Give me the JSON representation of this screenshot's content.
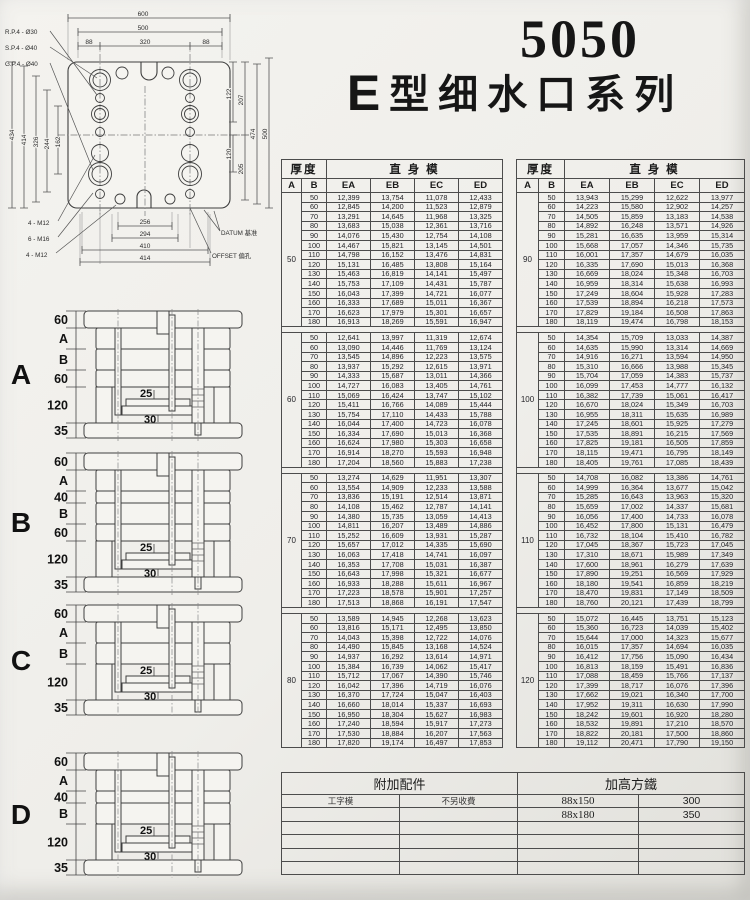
{
  "title": {
    "model": "5050",
    "series_e": "E",
    "series_rest": "型细水口系列"
  },
  "drawing": {
    "top_dims": [
      "600",
      "500",
      "88",
      "320",
      "88"
    ],
    "left_dims": [
      "434",
      "414",
      "326",
      "244",
      "162"
    ],
    "right_dims": [
      "122",
      "120",
      "207",
      "205",
      "474",
      "500"
    ],
    "bottom_dims": [
      "256",
      "294",
      "410",
      "414"
    ],
    "leader_labels": [
      "R.P.4 - Ø30",
      "S.P.4 - Ø40",
      "G.P.4 - Ø40"
    ],
    "screw_labels": [
      "4 - M12",
      "6 - M16",
      "4 - M12"
    ],
    "datum_label": "DATUM 基准",
    "offset_label": "OFFSET 偏孔"
  },
  "sections": [
    {
      "letter": "A",
      "bands": [
        "60",
        "A",
        "B",
        "60",
        "120",
        "35"
      ],
      "inner": [
        "25",
        "30"
      ]
    },
    {
      "letter": "B",
      "bands": [
        "60",
        "A",
        "40",
        "B",
        "60",
        "120",
        "35"
      ],
      "inner": [
        "25",
        "30"
      ]
    },
    {
      "letter": "C",
      "bands": [
        "60",
        "A",
        "B",
        "120",
        "35"
      ],
      "inner": [
        "25",
        "30"
      ]
    },
    {
      "letter": "D",
      "bands": [
        "60",
        "A",
        "40",
        "B",
        "120",
        "35"
      ],
      "inner": [
        "25",
        "30"
      ]
    }
  ],
  "price_tables": {
    "header": {
      "thickness": "厚度",
      "straight": "直 身 模",
      "a": "A",
      "b": "B",
      "cols": [
        "EA",
        "EB",
        "EC",
        "ED"
      ]
    },
    "left_groups": [
      {
        "a": "50",
        "rows": [
          [
            "50",
            "12,399",
            "13,754",
            "11,078",
            "12,433"
          ],
          [
            "60",
            "12,845",
            "14,200",
            "11,523",
            "12,879"
          ],
          [
            "70",
            "13,291",
            "14,645",
            "11,968",
            "13,325"
          ],
          [
            "80",
            "13,683",
            "15,038",
            "12,361",
            "13,716"
          ],
          [
            "90",
            "14,076",
            "15,430",
            "12,754",
            "14,108"
          ],
          [
            "100",
            "14,467",
            "15,821",
            "13,145",
            "14,501"
          ],
          [
            "110",
            "14,798",
            "16,152",
            "13,476",
            "14,831"
          ],
          [
            "120",
            "15,131",
            "16,485",
            "13,808",
            "15,164"
          ],
          [
            "130",
            "15,463",
            "16,819",
            "14,141",
            "15,497"
          ],
          [
            "140",
            "15,753",
            "17,109",
            "14,431",
            "15,787"
          ],
          [
            "150",
            "16,043",
            "17,399",
            "14,721",
            "16,077"
          ],
          [
            "160",
            "16,333",
            "17,689",
            "15,011",
            "16,367"
          ],
          [
            "170",
            "16,623",
            "17,979",
            "15,301",
            "16,657"
          ],
          [
            "180",
            "16,913",
            "18,269",
            "15,591",
            "16,947"
          ]
        ]
      },
      {
        "a": "60",
        "rows": [
          [
            "50",
            "12,641",
            "13,997",
            "11,319",
            "12,674"
          ],
          [
            "60",
            "13,090",
            "14,446",
            "11,769",
            "13,124"
          ],
          [
            "70",
            "13,545",
            "14,896",
            "12,223",
            "13,575"
          ],
          [
            "80",
            "13,937",
            "15,292",
            "12,615",
            "13,971"
          ],
          [
            "90",
            "14,333",
            "15,687",
            "13,011",
            "14,366"
          ],
          [
            "100",
            "14,727",
            "16,083",
            "13,405",
            "14,761"
          ],
          [
            "110",
            "15,069",
            "16,424",
            "13,747",
            "15,102"
          ],
          [
            "120",
            "15,411",
            "16,766",
            "14,089",
            "15,444"
          ],
          [
            "130",
            "15,754",
            "17,110",
            "14,433",
            "15,788"
          ],
          [
            "140",
            "16,044",
            "17,400",
            "14,723",
            "16,078"
          ],
          [
            "150",
            "16,334",
            "17,690",
            "15,013",
            "16,368"
          ],
          [
            "160",
            "16,624",
            "17,980",
            "15,303",
            "16,658"
          ],
          [
            "170",
            "16,914",
            "18,270",
            "15,593",
            "16,948"
          ],
          [
            "180",
            "17,204",
            "18,560",
            "15,883",
            "17,238"
          ]
        ]
      },
      {
        "a": "70",
        "rows": [
          [
            "50",
            "13,274",
            "14,629",
            "11,951",
            "13,307"
          ],
          [
            "60",
            "13,554",
            "14,909",
            "12,233",
            "13,588"
          ],
          [
            "70",
            "13,836",
            "15,191",
            "12,514",
            "13,871"
          ],
          [
            "80",
            "14,108",
            "15,462",
            "12,787",
            "14,141"
          ],
          [
            "90",
            "14,380",
            "15,735",
            "13,059",
            "14,413"
          ],
          [
            "100",
            "14,811",
            "16,207",
            "13,489",
            "14,886"
          ],
          [
            "110",
            "15,252",
            "16,609",
            "13,931",
            "15,287"
          ],
          [
            "120",
            "15,657",
            "17,012",
            "14,335",
            "15,690"
          ],
          [
            "130",
            "16,063",
            "17,418",
            "14,741",
            "16,097"
          ],
          [
            "140",
            "16,353",
            "17,708",
            "15,031",
            "16,387"
          ],
          [
            "150",
            "16,643",
            "17,998",
            "15,321",
            "16,677"
          ],
          [
            "160",
            "16,933",
            "18,288",
            "15,611",
            "16,967"
          ],
          [
            "170",
            "17,223",
            "18,578",
            "15,901",
            "17,257"
          ],
          [
            "180",
            "17,513",
            "18,868",
            "16,191",
            "17,547"
          ]
        ]
      },
      {
        "a": "80",
        "rows": [
          [
            "50",
            "13,589",
            "14,945",
            "12,268",
            "13,623"
          ],
          [
            "60",
            "13,816",
            "15,171",
            "12,495",
            "13,850"
          ],
          [
            "70",
            "14,043",
            "15,398",
            "12,722",
            "14,076"
          ],
          [
            "80",
            "14,490",
            "15,845",
            "13,168",
            "14,524"
          ],
          [
            "90",
            "14,937",
            "16,292",
            "13,614",
            "14,971"
          ],
          [
            "100",
            "15,384",
            "16,739",
            "14,062",
            "15,417"
          ],
          [
            "110",
            "15,712",
            "17,067",
            "14,390",
            "15,746"
          ],
          [
            "120",
            "16,042",
            "17,396",
            "14,719",
            "16,076"
          ],
          [
            "130",
            "16,370",
            "17,724",
            "15,047",
            "16,403"
          ],
          [
            "140",
            "16,660",
            "18,014",
            "15,337",
            "16,693"
          ],
          [
            "150",
            "16,950",
            "18,304",
            "15,627",
            "16,983"
          ],
          [
            "160",
            "17,240",
            "18,594",
            "15,917",
            "17,273"
          ],
          [
            "170",
            "17,530",
            "18,884",
            "16,207",
            "17,563"
          ],
          [
            "180",
            "17,820",
            "19,174",
            "16,497",
            "17,853"
          ]
        ]
      }
    ],
    "right_groups": [
      {
        "a": "90",
        "rows": [
          [
            "50",
            "13,943",
            "15,299",
            "12,622",
            "13,977"
          ],
          [
            "60",
            "14,223",
            "15,580",
            "12,902",
            "14,257"
          ],
          [
            "70",
            "14,505",
            "15,859",
            "13,183",
            "14,538"
          ],
          [
            "80",
            "14,892",
            "16,248",
            "13,571",
            "14,926"
          ],
          [
            "90",
            "15,281",
            "16,635",
            "13,959",
            "15,314"
          ],
          [
            "100",
            "15,668",
            "17,057",
            "14,346",
            "15,735"
          ],
          [
            "110",
            "16,001",
            "17,357",
            "14,679",
            "16,035"
          ],
          [
            "120",
            "16,335",
            "17,690",
            "15,013",
            "16,368"
          ],
          [
            "130",
            "16,669",
            "18,024",
            "15,348",
            "16,703"
          ],
          [
            "140",
            "16,959",
            "18,314",
            "15,638",
            "16,993"
          ],
          [
            "150",
            "17,249",
            "18,604",
            "15,928",
            "17,283"
          ],
          [
            "160",
            "17,539",
            "18,894",
            "16,218",
            "17,573"
          ],
          [
            "170",
            "17,829",
            "19,184",
            "16,508",
            "17,863"
          ],
          [
            "180",
            "18,119",
            "19,474",
            "16,798",
            "18,153"
          ]
        ]
      },
      {
        "a": "100",
        "rows": [
          [
            "50",
            "14,354",
            "15,709",
            "13,033",
            "14,387"
          ],
          [
            "60",
            "14,635",
            "15,990",
            "13,314",
            "14,669"
          ],
          [
            "70",
            "14,916",
            "16,271",
            "13,594",
            "14,950"
          ],
          [
            "80",
            "15,310",
            "16,666",
            "13,988",
            "15,345"
          ],
          [
            "90",
            "15,704",
            "17,059",
            "14,383",
            "15,737"
          ],
          [
            "100",
            "16,099",
            "17,453",
            "14,777",
            "16,132"
          ],
          [
            "110",
            "16,382",
            "17,739",
            "15,061",
            "16,417"
          ],
          [
            "120",
            "16,670",
            "18,024",
            "15,349",
            "16,703"
          ],
          [
            "130",
            "16,955",
            "18,311",
            "15,635",
            "16,989"
          ],
          [
            "140",
            "17,245",
            "18,601",
            "15,925",
            "17,279"
          ],
          [
            "150",
            "17,535",
            "18,891",
            "16,215",
            "17,569"
          ],
          [
            "160",
            "17,825",
            "19,181",
            "16,505",
            "17,859"
          ],
          [
            "170",
            "18,115",
            "19,471",
            "16,795",
            "18,149"
          ],
          [
            "180",
            "18,405",
            "19,761",
            "17,085",
            "18,439"
          ]
        ]
      },
      {
        "a": "110",
        "rows": [
          [
            "50",
            "14,708",
            "16,082",
            "13,386",
            "14,761"
          ],
          [
            "60",
            "14,999",
            "16,364",
            "13,677",
            "15,042"
          ],
          [
            "70",
            "15,285",
            "16,643",
            "13,963",
            "15,320"
          ],
          [
            "80",
            "15,659",
            "17,002",
            "14,337",
            "15,681"
          ],
          [
            "90",
            "16,056",
            "17,400",
            "14,733",
            "16,078"
          ],
          [
            "100",
            "16,452",
            "17,800",
            "15,131",
            "16,479"
          ],
          [
            "110",
            "16,732",
            "18,104",
            "15,410",
            "16,782"
          ],
          [
            "120",
            "17,045",
            "18,367",
            "15,723",
            "17,045"
          ],
          [
            "130",
            "17,310",
            "18,671",
            "15,989",
            "17,349"
          ],
          [
            "140",
            "17,600",
            "18,961",
            "16,279",
            "17,639"
          ],
          [
            "150",
            "17,890",
            "19,251",
            "16,569",
            "17,929"
          ],
          [
            "160",
            "18,180",
            "19,541",
            "16,859",
            "18,219"
          ],
          [
            "170",
            "18,470",
            "19,831",
            "17,149",
            "18,509"
          ],
          [
            "180",
            "18,760",
            "20,121",
            "17,439",
            "18,799"
          ]
        ]
      },
      {
        "a": "120",
        "rows": [
          [
            "50",
            "15,072",
            "16,445",
            "13,751",
            "15,123"
          ],
          [
            "60",
            "15,360",
            "16,723",
            "14,039",
            "15,402"
          ],
          [
            "70",
            "15,644",
            "17,000",
            "14,323",
            "15,677"
          ],
          [
            "80",
            "16,015",
            "17,357",
            "14,694",
            "16,035"
          ],
          [
            "90",
            "16,412",
            "17,756",
            "15,090",
            "16,434"
          ],
          [
            "100",
            "16,813",
            "18,159",
            "15,491",
            "16,836"
          ],
          [
            "110",
            "17,088",
            "18,459",
            "15,766",
            "17,137"
          ],
          [
            "120",
            "17,399",
            "18,717",
            "16,076",
            "17,396"
          ],
          [
            "130",
            "17,662",
            "19,021",
            "16,340",
            "17,700"
          ],
          [
            "140",
            "17,952",
            "19,311",
            "16,630",
            "17,990"
          ],
          [
            "150",
            "18,242",
            "19,601",
            "16,920",
            "18,280"
          ],
          [
            "160",
            "18,532",
            "19,891",
            "17,210",
            "18,570"
          ],
          [
            "170",
            "18,822",
            "20,181",
            "17,500",
            "18,860"
          ],
          [
            "180",
            "19,112",
            "20,471",
            "17,790",
            "19,150"
          ]
        ]
      }
    ]
  },
  "accessories": {
    "left_header": "附加配件",
    "right_header": "加高方鐵",
    "col1": "工字模",
    "col2": "不另收費",
    "size_rows": [
      {
        "size": "88x150",
        "height": "300"
      },
      {
        "size": "88x180",
        "height": "350"
      }
    ],
    "empty_rows": 4
  }
}
